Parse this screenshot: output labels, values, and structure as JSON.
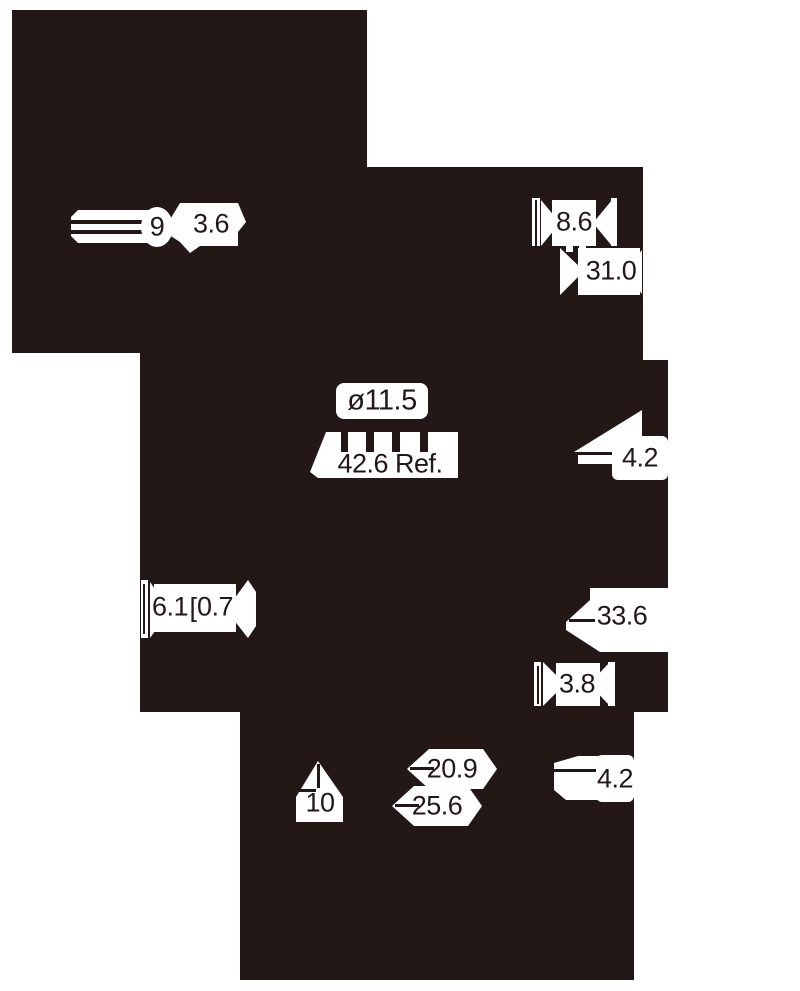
{
  "drawing": {
    "paper_color": "#ffffff",
    "ink_color": "#231815",
    "dimensions": {
      "pin_length": "9",
      "pin_diameter": "3.6",
      "plug_width": "8.6",
      "plug_length": "31.0",
      "body_diameter": "ø11.5",
      "overall_length": "42.6 Ref.",
      "taper_length": "4.2",
      "left_gap": "6.1",
      "left_bracket": "[",
      "left_offset": "0.7",
      "shaft_length": "33.6",
      "shaft_diameter": "3.8",
      "base_height": "10",
      "inner_width": "20.9",
      "outer_width": "25.6",
      "tip_length": "4.2"
    }
  }
}
